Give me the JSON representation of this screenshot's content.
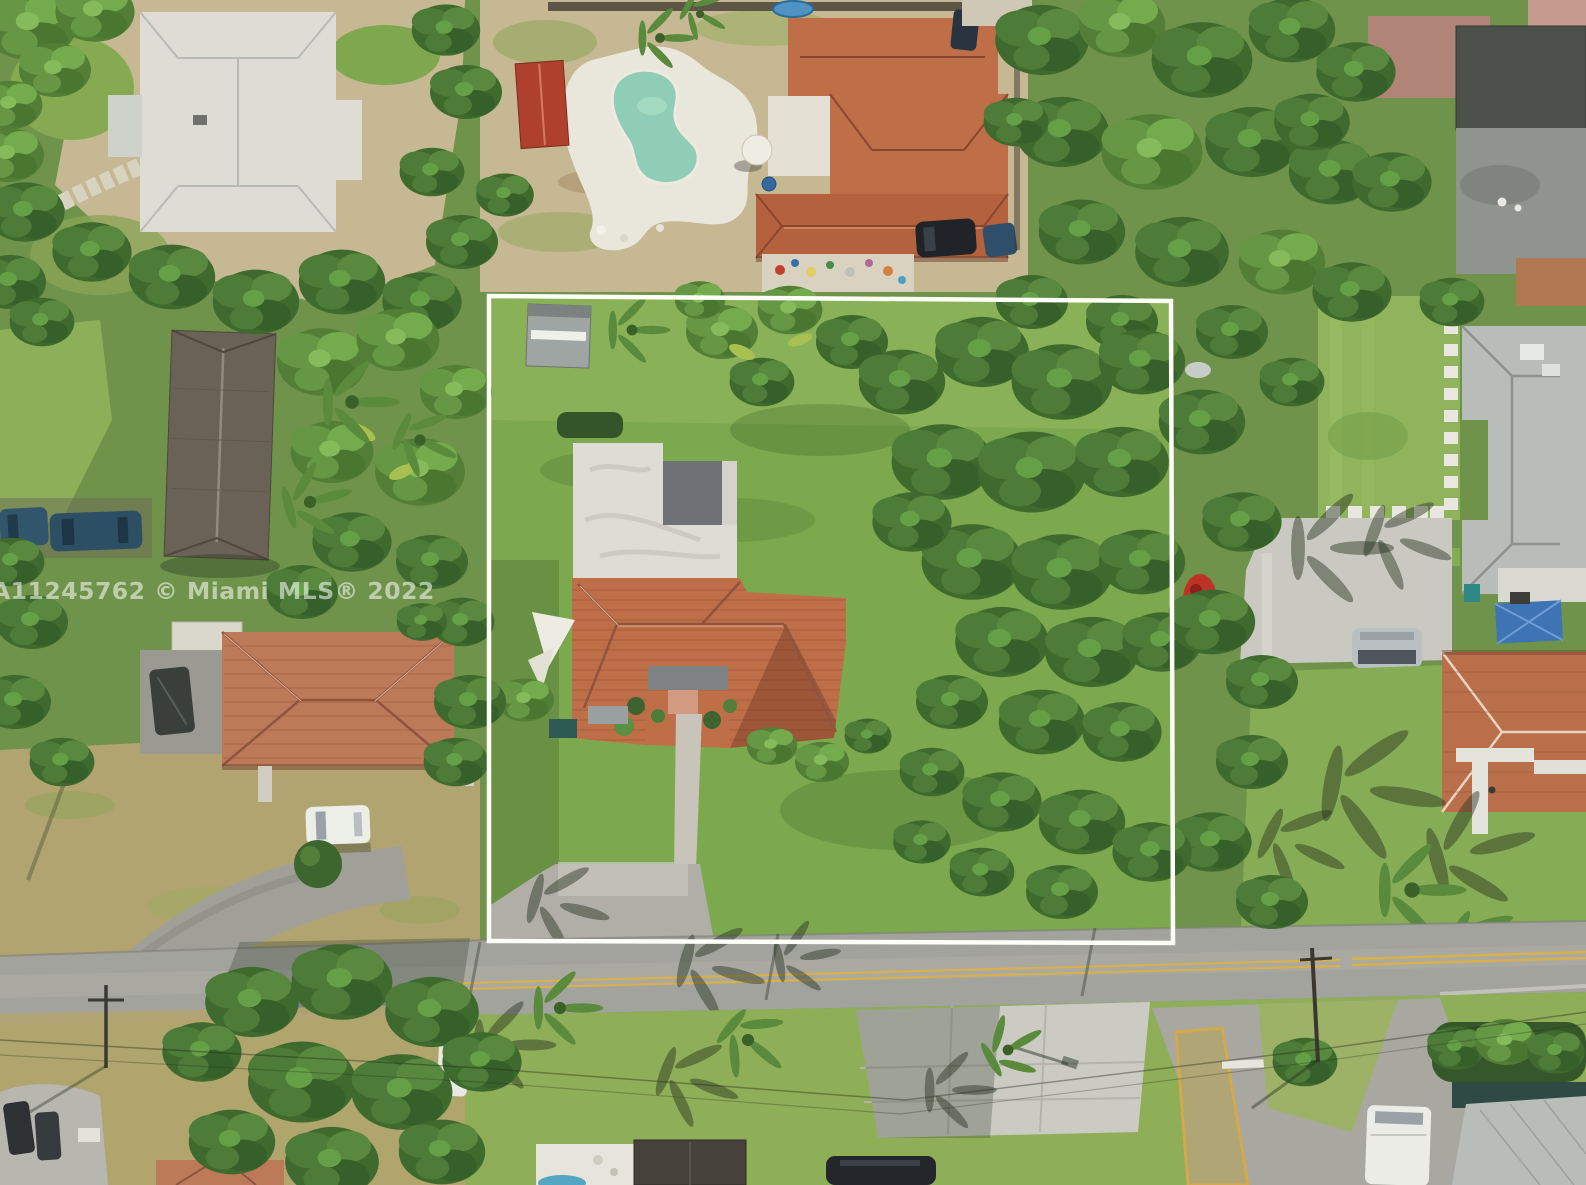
{
  "image": {
    "type": "aerial-drone-photograph",
    "description": "Overhead aerial view of a suburban Miami single-family lot outlined with a white property-boundary rectangle; the lot holds a tile-roof house with flat white roof section, shed, lawn and driveway, surrounded by neighboring homes, a kidney-shaped pool, dense tropical tree canopy, parked cars and a street with yellow center line along the bottom.",
    "watermark_text": "A11245762 © Miami MLS® 2022"
  },
  "scene_objects": [
    "property-boundary-outline",
    "subject-house-terracotta-roof",
    "subject-flat-white-roof",
    "storage-shed",
    "shade-sail",
    "front-walkway",
    "driveway",
    "neighbor-pool",
    "pool-deck",
    "red-shed",
    "rear-neighbor-house",
    "top-left-estate-house",
    "left-dark-roof-house",
    "left-salmon-roof-house",
    "right-gray-shingle-house",
    "right-orange-roof-house",
    "blue-canopy",
    "street",
    "yellow-center-line",
    "side-street-median",
    "parked-cars",
    "white-van",
    "tree-canopy",
    "palm-trees",
    "mls-watermark"
  ],
  "colors": {
    "boundary_white": "#fdfdf8",
    "watermark_white": "rgba(255,255,255,0.55)",
    "lawn_green": "#7ca84e",
    "dry_lawn_tan": "#b2a470",
    "terracotta_roof": "#bf6f48",
    "salmon_roof": "#bd7a58",
    "white_roof_gray": "#dedcd4",
    "dark_shingle_roof": "#6b6257",
    "charcoal_roof": "#4c504b",
    "gray_shingle_roof": "#b9bdb9",
    "pool_teal": "#8fcdb6",
    "asphalt_road_gray": "#a3a39d",
    "concrete_gray": "#c9c9c1",
    "sand_dirt_tan": "#c6b893",
    "lane_line_yellow": "#d9b14c",
    "red_shed_roof": "#b0402e",
    "shade_sail_white": "#eeece2",
    "canopy_dark_green": "#3f6a2e",
    "canopy_light_green": "#6da24f"
  }
}
